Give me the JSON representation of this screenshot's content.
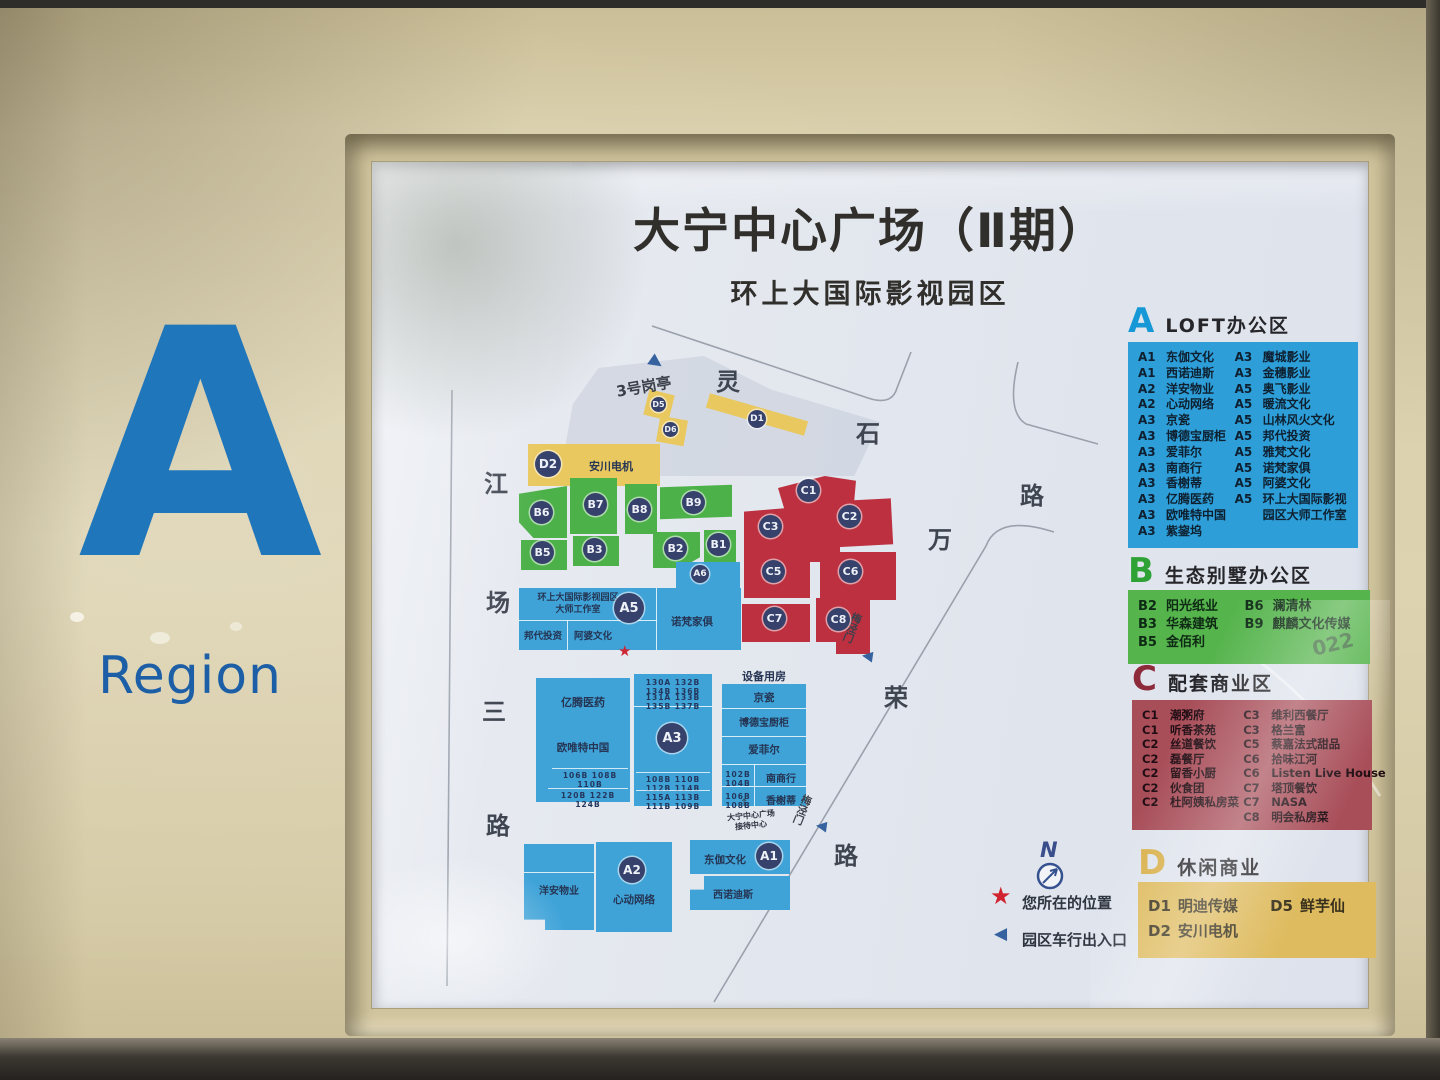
{
  "region": {
    "letter": "A",
    "word": "Region"
  },
  "board": {
    "title": "大宁中心广场（Ⅱ期）",
    "subtitle": "环上大国际影视园区"
  },
  "map": {
    "streets": {
      "left": [
        "江",
        "场",
        "三",
        "路"
      ],
      "top": [
        "灵",
        "石",
        "路"
      ],
      "right": [
        "万",
        "荣",
        "路"
      ]
    },
    "guard_post": "3号岗亭",
    "gate_label": "梅泾门",
    "compass": "N",
    "you_are_here": "您所在的位置",
    "vehicle_entrance": "园区车行出入口",
    "equipment_room": "设备用房",
    "reception_line1": "大宁中心广场",
    "reception_line2": "接待中心",
    "badges": {
      "d1": "D1",
      "d2": "D2",
      "d5": "D5",
      "d6": "D6",
      "b1": "B1",
      "b2": "B2",
      "b3": "B3",
      "b5": "B5",
      "b6": "B6",
      "b7": "B7",
      "b8": "B8",
      "b9": "B9",
      "a1": "A1",
      "a2": "A2",
      "a3": "A3",
      "a5": "A5",
      "a6": "A6",
      "c1": "C1",
      "c2": "C2",
      "c3": "C3",
      "c5": "C5",
      "c6": "C6",
      "c7": "C7",
      "c8": "C8"
    },
    "labels": {
      "d2_tenant": "安川电机",
      "a5_line1": "环上大国际影视园区",
      "a5_line2": "大师工作室",
      "a5_tenant1": "邦代投资",
      "a5_tenant2": "阿婆文化",
      "a5_tenant3": "诺梵家俱",
      "a3_left_top": "亿腾医药",
      "a3_left_mid": "欧唯特中国",
      "a3_right_r1": "京瓷",
      "a3_right_r2": "博德宝厨柜",
      "a3_right_r3": "爱菲尔",
      "a3_right_r4": "南商行",
      "a3_right_r5": "香榭蒂",
      "a2_tenant1": "洋安物业",
      "a2_tenant2": "心动网络",
      "a1_tenant1": "东伽文化",
      "a1_tenant2": "西诺迪斯",
      "nums_left_r1": "106B 108B 110B",
      "nums_left_r2": "120B 122B 124B",
      "nums_mid_t1": "130A 132B 134B 136B",
      "nums_mid_t2": "131A 133B 135B 137B",
      "nums_mid_b1": "108B 110B 112B 114B",
      "nums_mid_b2": "115A 113B 111B 109B",
      "nums_right_r4": "102B 104B",
      "nums_right_r5": "106B 108B"
    }
  },
  "legend_panels": [
    {
      "letter": "A",
      "title": "LOFT办公区",
      "panel_color": "#2d9ed8",
      "letter_color": "#1798d6",
      "left": [
        {
          "code": "A1",
          "name": "东伽文化"
        },
        {
          "code": "A1",
          "name": "西诺迪斯"
        },
        {
          "code": "A2",
          "name": "洋安物业"
        },
        {
          "code": "A2",
          "name": "心动网络"
        },
        {
          "code": "A3",
          "name": "京瓷"
        },
        {
          "code": "A3",
          "name": "博德宝厨柜"
        },
        {
          "code": "A3",
          "name": "爱菲尔"
        },
        {
          "code": "A3",
          "name": "南商行"
        },
        {
          "code": "A3",
          "name": "香榭蒂"
        },
        {
          "code": "A3",
          "name": "亿腾医药"
        },
        {
          "code": "A3",
          "name": "欧唯特中国"
        },
        {
          "code": "A3",
          "name": "紫鋆坞"
        }
      ],
      "right": [
        {
          "code": "A3",
          "name": "魔城影业"
        },
        {
          "code": "A3",
          "name": "金穗影业"
        },
        {
          "code": "A5",
          "name": "奥飞影业"
        },
        {
          "code": "A5",
          "name": "暖流文化"
        },
        {
          "code": "A5",
          "name": "山林风火文化"
        },
        {
          "code": "A5",
          "name": "邦代投资"
        },
        {
          "code": "A5",
          "name": "雅梵文化"
        },
        {
          "code": "A5",
          "name": "诺梵家俱"
        },
        {
          "code": "A5",
          "name": "阿婆文化"
        },
        {
          "code": "A5",
          "name": "环上大国际影视"
        },
        {
          "code": "",
          "name": "园区大师工作室"
        }
      ]
    },
    {
      "letter": "B",
      "title": "生态别墅办公区",
      "panel_color": "#55b44c",
      "letter_color": "#2fa235",
      "left": [
        {
          "code": "B2",
          "name": "阳光纸业"
        },
        {
          "code": "B3",
          "name": "华森建筑"
        },
        {
          "code": "B5",
          "name": "金佰利"
        }
      ],
      "right": [
        {
          "code": "B6",
          "name": "澜清林"
        },
        {
          "code": "B9",
          "name": "麒麟文化传媒"
        }
      ]
    },
    {
      "letter": "C",
      "title": "配套商业区",
      "panel_color": "#a84e59",
      "letter_color": "#8e2b3b",
      "left": [
        {
          "code": "C1",
          "name": "潮粥府"
        },
        {
          "code": "C1",
          "name": "听香茶苑"
        },
        {
          "code": "C2",
          "name": "丝道餐饮"
        },
        {
          "code": "C2",
          "name": "磊餐厅"
        },
        {
          "code": "C2",
          "name": "留香小厨"
        },
        {
          "code": "C2",
          "name": "伙食团"
        },
        {
          "code": "C2",
          "name": "杜阿姨私房菜"
        }
      ],
      "right": [
        {
          "code": "C3",
          "name": "维利西餐厅"
        },
        {
          "code": "C3",
          "name": "格兰富"
        },
        {
          "code": "C5",
          "name": "蔡嘉法式甜品"
        },
        {
          "code": "C6",
          "name": "拾味江河"
        },
        {
          "code": "C6",
          "name": "Listen Live House"
        },
        {
          "code": "C7",
          "name": "塔顶餐饮"
        },
        {
          "code": "C7",
          "name": "NASA"
        },
        {
          "code": "C8",
          "name": "明会私房菜"
        }
      ]
    },
    {
      "letter": "D",
      "title": "休闲商业",
      "panel_color": "#debb5f",
      "letter_color": "#d9b14c",
      "left": [
        {
          "code": "D1",
          "name": "明迪传媒"
        },
        {
          "code": "D2",
          "name": "安川电机"
        }
      ],
      "right": [
        {
          "code": "D5",
          "name": "鲜芋仙"
        }
      ]
    }
  ],
  "photo_artifacts": {
    "scribble": "022"
  },
  "colors": {
    "zone_a_blue": "#3fa3d8",
    "zone_b_green": "#4db149",
    "zone_c_red": "#bc3040",
    "zone_d_yellow": "#e9c860",
    "badge_navy": "#36426b",
    "region_blue": "#2076bb",
    "sign_cream": "#d9cfab"
  }
}
